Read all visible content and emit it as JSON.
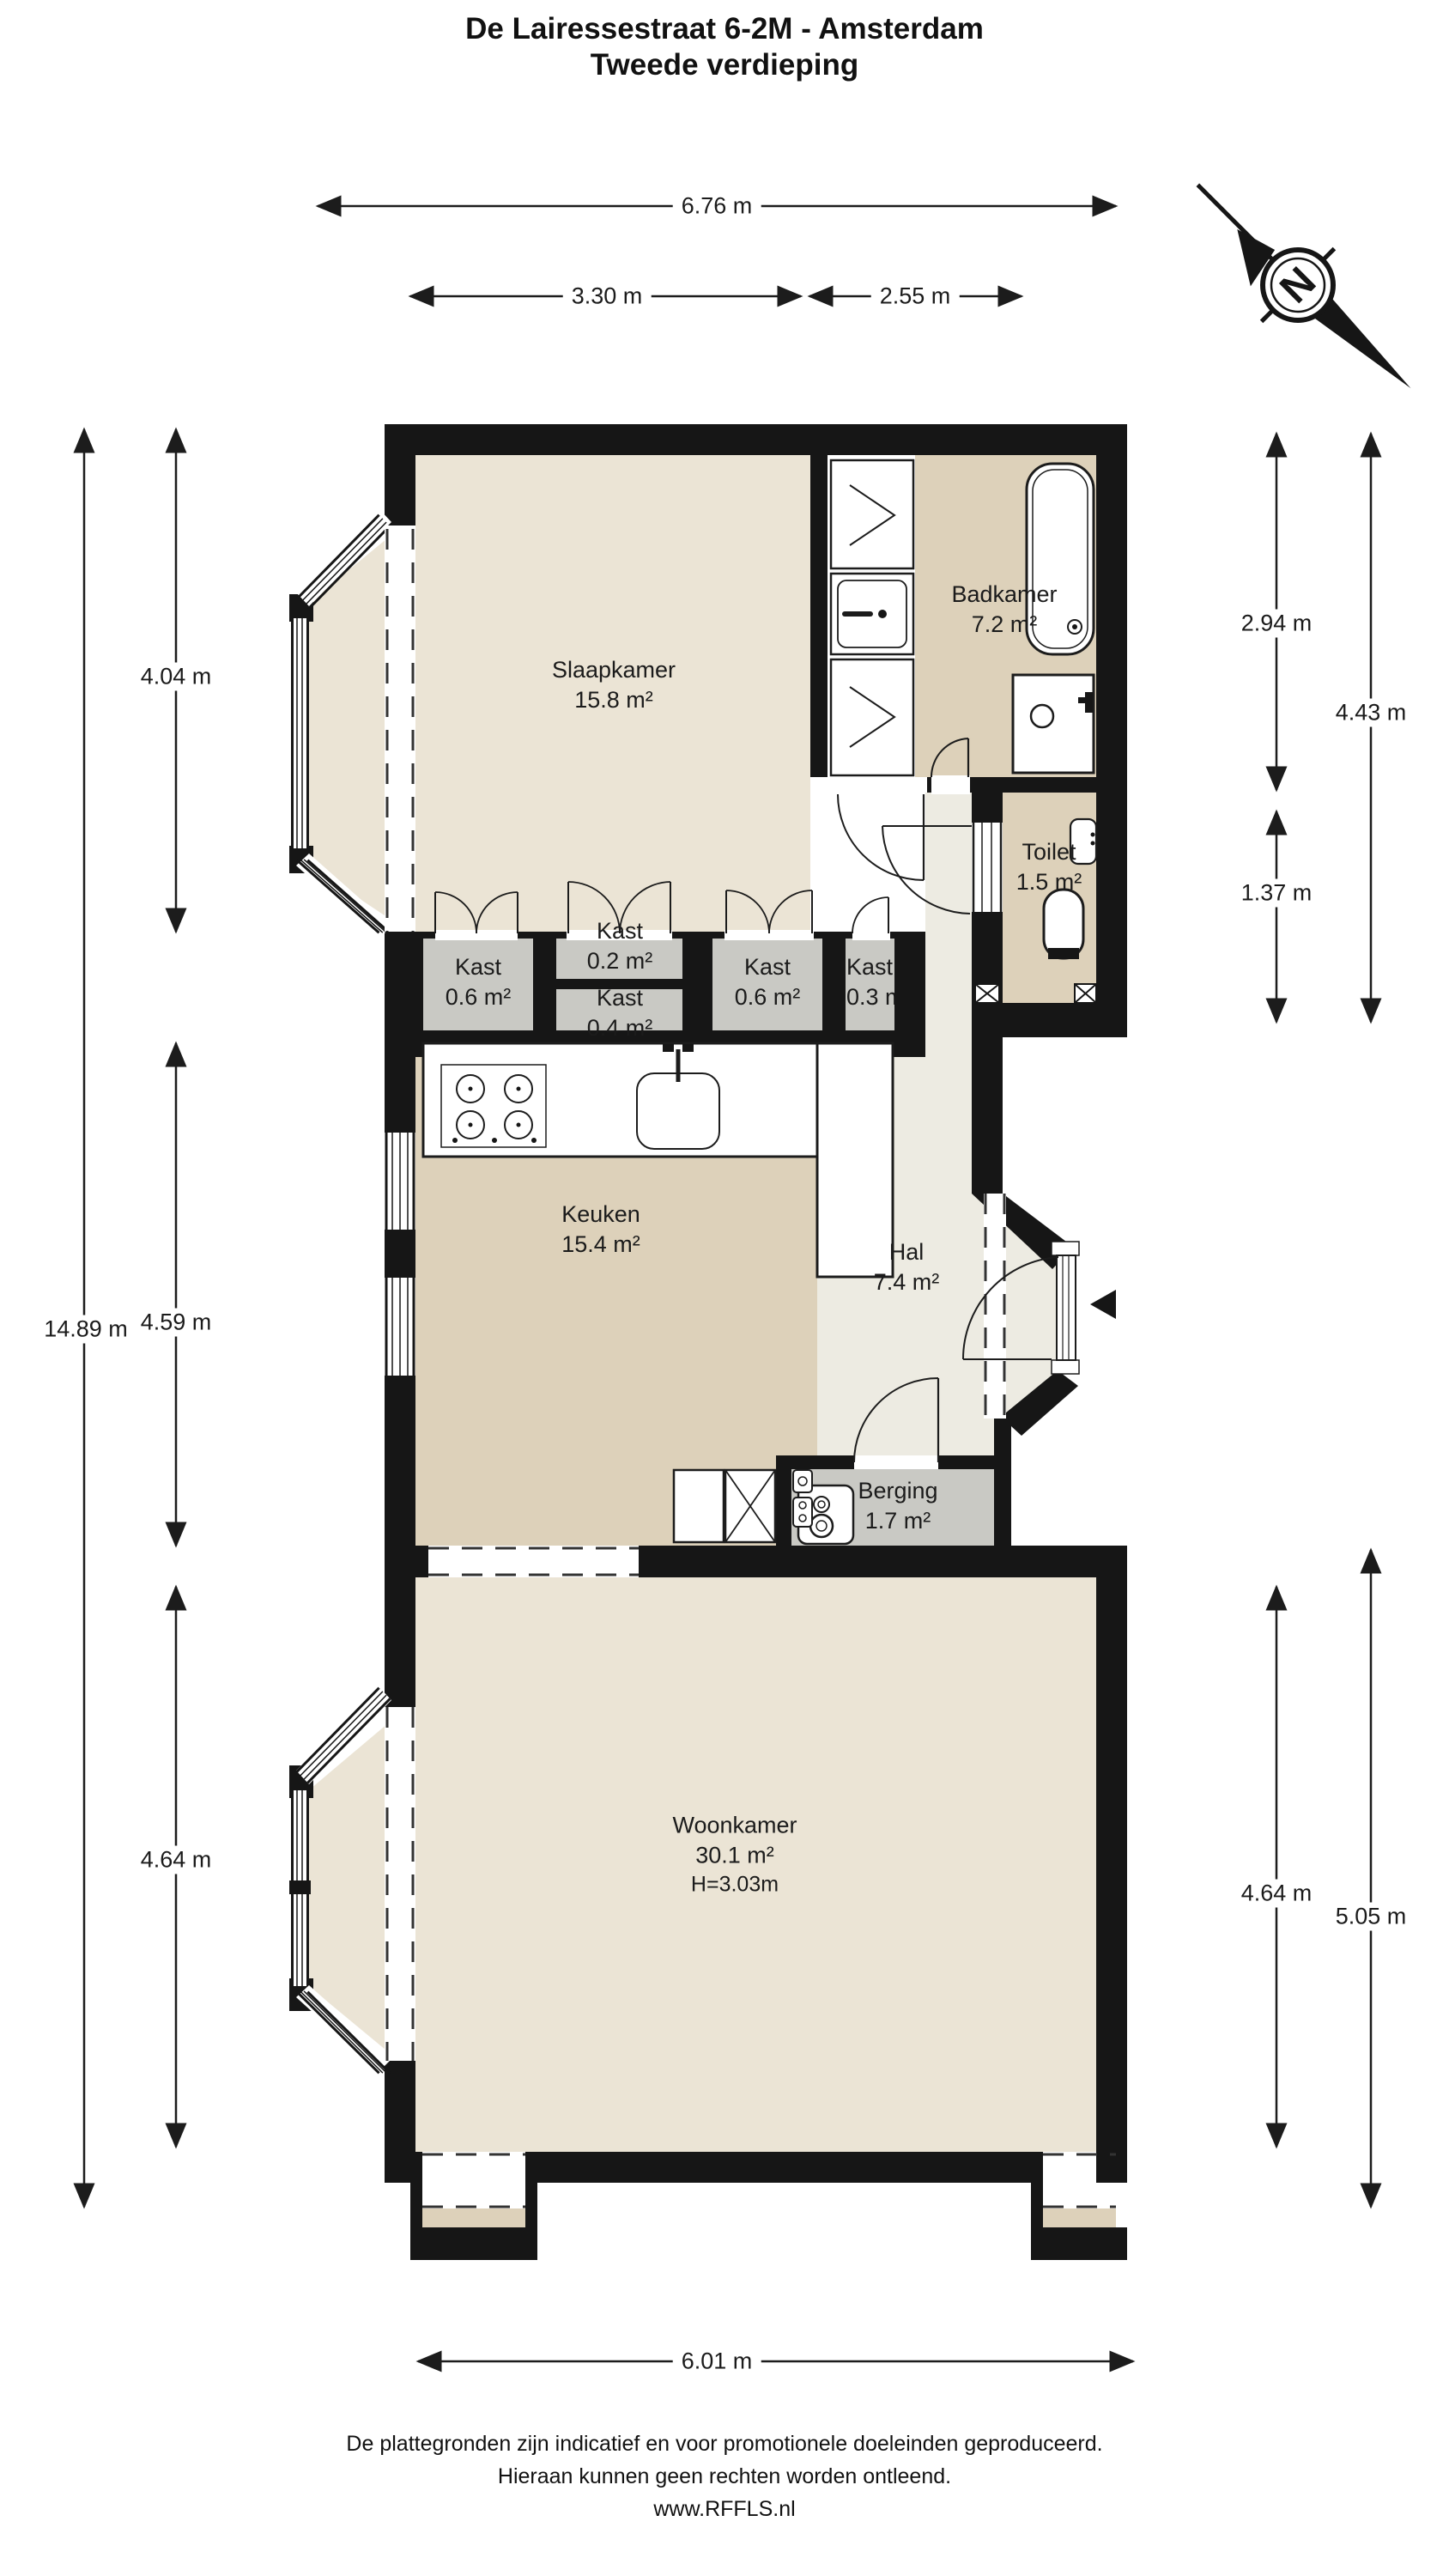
{
  "title": {
    "line1": "De Lairessestraat 6-2M - Amsterdam",
    "line2": "Tweede verdieping"
  },
  "rooms": {
    "slaapkamer": {
      "name": "Slaapkamer",
      "area": "15.8 m²"
    },
    "badkamer": {
      "name": "Badkamer",
      "area": "7.2 m²"
    },
    "toilet": {
      "name": "Toilet",
      "area": "1.5 m²"
    },
    "kast_a": {
      "name": "Kast",
      "area": "0.6 m²"
    },
    "kast_b": {
      "name": "Kast",
      "area": "0.2 m²"
    },
    "kast_c": {
      "name": "Kast",
      "area": "0.4 m²"
    },
    "kast_d": {
      "name": "Kast",
      "area": "0.6 m²"
    },
    "kast_e": {
      "name": "Kast",
      "area": "0.3 m²"
    },
    "keuken": {
      "name": "Keuken",
      "area": "15.4 m²"
    },
    "hal": {
      "name": "Hal",
      "area": "7.4 m²"
    },
    "berging": {
      "name": "Berging",
      "area": "1.7 m²"
    },
    "woonkamer": {
      "name": "Woonkamer",
      "area": "30.1 m²",
      "height": "H=3.03m"
    }
  },
  "dimensions": {
    "top_total": "6.76 m",
    "top_left": "3.30 m",
    "top_right": "2.55 m",
    "left_total": "14.89 m",
    "left_top": "4.04 m",
    "left_mid": "4.59 m",
    "left_bottom": "4.64 m",
    "right_top": "2.94 m",
    "right_outer_top": "4.43 m",
    "right_toilet": "1.37 m",
    "right_bottom": "4.64 m",
    "right_outer_bottom": "5.05 m",
    "bottom_total": "6.01 m"
  },
  "compass": {
    "north_label": "N"
  },
  "footer": {
    "line1": "De plattegronden zijn indicatief en voor promotionele doeleinden geproduceerd.",
    "line2": "Hieraan kunnen geen rechten worden ontleend.",
    "line3": "www.RFFLS.nl"
  },
  "palette": {
    "wall": "#161616",
    "room_light": "#EBE4D5",
    "room_tan": "#DDD1BA",
    "hall": "#EDEBE2",
    "closet_gray": "#C9C9C4",
    "line": "#1c1c1c"
  }
}
